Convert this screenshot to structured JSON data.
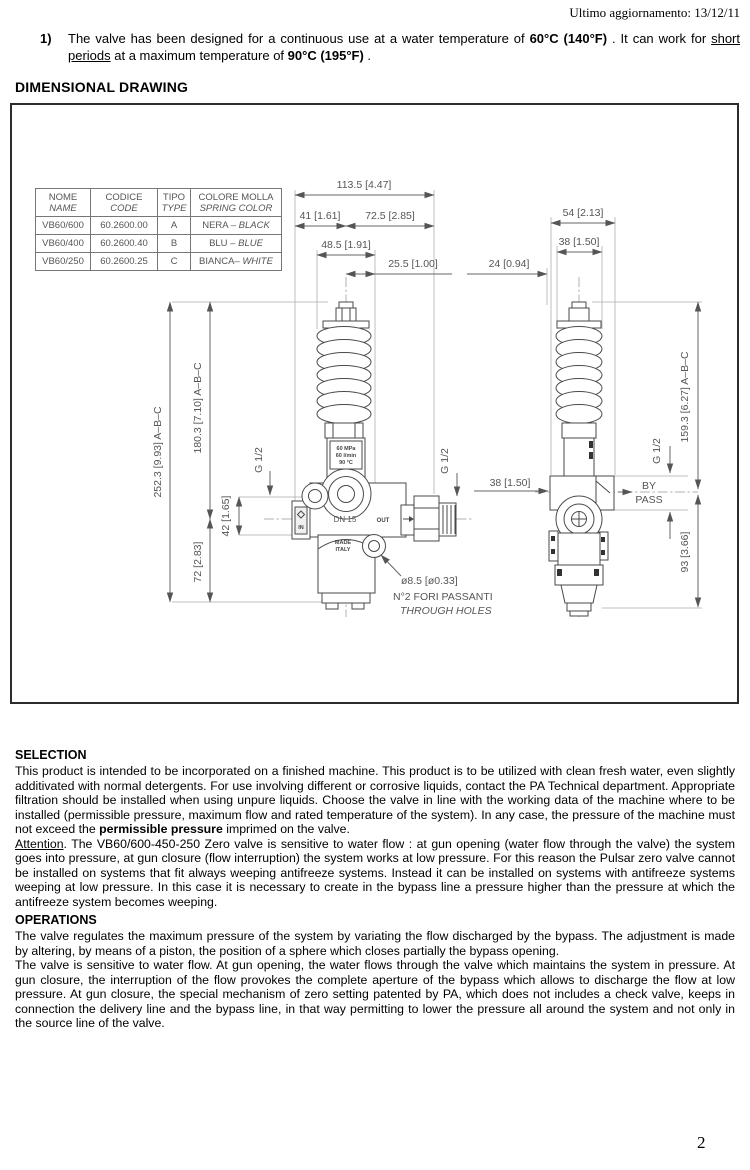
{
  "page": {
    "updated": "Ultimo aggiornamento: 13/12/11",
    "page_number": "2"
  },
  "note1": {
    "num": "1)",
    "t1": "The valve has been designed for a continuous use at a water temperature of ",
    "b1": "60°C (140°F)",
    "t2": " . It can work for ",
    "u1": "short periods",
    "t3": " at a maximum temperature of ",
    "b2": "90°C (195°F)",
    "t4": " ."
  },
  "drawing": {
    "title": "DIMENSIONAL DRAWING",
    "table": {
      "headers": [
        {
          "it": "NOME",
          "en": "NAME"
        },
        {
          "it": "CODICE",
          "en": "CODE"
        },
        {
          "it": "TIPO",
          "en": "TYPE"
        },
        {
          "it": "COLORE MOLLA",
          "en": "SPRING COLOR"
        }
      ],
      "rows": [
        {
          "name": "VB60/600",
          "code": "60.2600.00",
          "type": "A",
          "spring_it": "NERA – ",
          "spring_en": "BLACK"
        },
        {
          "name": "VB60/400",
          "code": "60.2600.40",
          "type": "B",
          "spring_it": "BLU – ",
          "spring_en": "BLUE"
        },
        {
          "name": "VB60/250",
          "code": "60.2600.25",
          "type": "C",
          "spring_it": "BIANCA– ",
          "spring_en": "WHITE"
        }
      ]
    },
    "front_view": {
      "dim_total": "113.5 [4.47]",
      "dim_41": "41 [1.61]",
      "dim_725": "72.5 [2.85]",
      "dim_485": "48.5 [1.91]",
      "dim_255": "25.5 [1.00]",
      "dim_2523": "252.3 [9.93] A–B–C",
      "dim_1803": "180.3 [7.10] A–B–C",
      "dim_42": "42 [1.65]",
      "dim_72": "72 [2.83]",
      "g12_left": "G 1/2",
      "g12_right": "G 1/2",
      "plate1": "60 MPa",
      "plate2": "60 l/min",
      "plate3": "90 °C",
      "plate4": "BY-PASS",
      "dn15": "DN 15",
      "in_label": "IN",
      "out_label": "OUT",
      "made1": "MADE",
      "made2": "ITALY",
      "hole_dia": "ø8.5 [ø0.33]",
      "hole_note_it": "N°2 FORI PASSANTI",
      "hole_note_en": "THROUGH HOLES"
    },
    "side_view": {
      "dim_54": "54 [2.13]",
      "dim_38_top": "38 [1.50]",
      "dim_24": "24 [0.94]",
      "dim_38_left": "38 [1.50]",
      "bypass1": "BY",
      "bypass2": "PASS",
      "g12": "G 1/2",
      "dim_1593": "159.3 [6.27] A–B–C",
      "dim_93": "93 [3.66]"
    }
  },
  "selection": {
    "heading": "SELECTION",
    "p1a": "This product is intended to be incorporated on a finished machine. This product is to be utilized with clean fresh water, even slightly additivated with normal detergents. For use involving different or corrosive liquids, contact the PA Technical department. Appropriate filtration should be installed when using unpure liquids. Choose the valve in line with the working data of the machine where to be installed (permissible pressure, maximum flow and rated temperature of the system). In any case, the pressure of the machine must not exceed the ",
    "p1b": "permissible pressure",
    "p1c": " imprimed on the valve.",
    "att_word": "Attention",
    "att_rest": ". The VB60/600-450-250 Zero valve is sensitive to water flow : at gun opening (water flow through the valve) the system goes into pressure, at gun closure (flow interruption) the system works at low pressure. For this reason the Pulsar zero valve cannot be installed on systems that fit always weeping antifreeze systems. Instead it can be installed on systems with antifreeze systems weeping at low pressure. In this case it is necessary to create in the bypass line a pressure higher than the pressure at which the antifreeze system becomes weeping."
  },
  "operations": {
    "heading": "OPERATIONS",
    "p1": "The valve regulates the maximum pressure of the system by variating the flow discharged by the bypass. The adjustment is made by altering, by means of a piston, the position of a sphere which closes partially the bypass opening.",
    "p2": "The valve is sensitive to water flow. At gun opening, the water flows through the valve which maintains the system in pressure. At gun closure, the interruption of the flow provokes the complete aperture of the bypass which allows to discharge the flow at low pressure. At gun closure, the special mechanism of zero setting patented by PA, which does not includes a check valve, keeps in connection the delivery line and the bypass line, in that way permitting to lower the pressure all around the system and not only in the source line of the valve."
  }
}
